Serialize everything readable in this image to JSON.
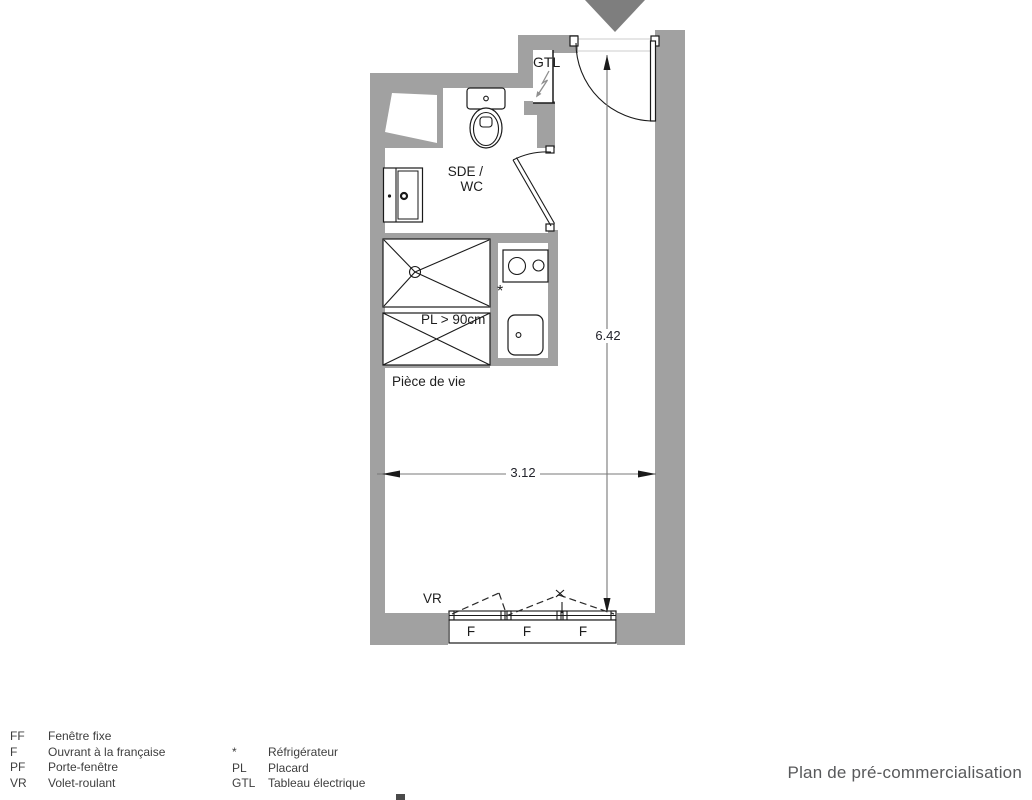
{
  "title": "Plan de pré-commercialisation",
  "plan": {
    "rooms": {
      "bathroom_line1": "SDE /",
      "bathroom_line2": "WC",
      "living": "Pièce de vie"
    },
    "labels": {
      "electrical_panel": "GTL",
      "closet": "PL > 90cm",
      "roller_shutter": "VR",
      "fridge_marker": "*"
    },
    "window_panels": [
      "F",
      "F",
      "F"
    ],
    "dimensions": {
      "height_m": "6.42",
      "width_m": "3.12"
    }
  },
  "legend": {
    "left": [
      {
        "abbr": "FF",
        "label": "Fenêtre fixe"
      },
      {
        "abbr": "F",
        "label": "Ouvrant à la française"
      },
      {
        "abbr": "PF",
        "label": "Porte-fenêtre"
      },
      {
        "abbr": "VR",
        "label": "Volet-roulant"
      }
    ],
    "right": [
      {
        "abbr": "*",
        "label": "Réfrigérateur"
      },
      {
        "abbr": "PL",
        "label": "Placard"
      },
      {
        "abbr": "GTL",
        "label": "Tableau électrique"
      }
    ]
  },
  "colors": {
    "wall": "#a1a1a1",
    "entrance_marker": "#7e7e7e",
    "line": "#1a1a1a",
    "dimension_line": "#787878",
    "text": "#1d1d1d",
    "legend_text": "#3e3e3e",
    "title_text": "#58595b"
  }
}
